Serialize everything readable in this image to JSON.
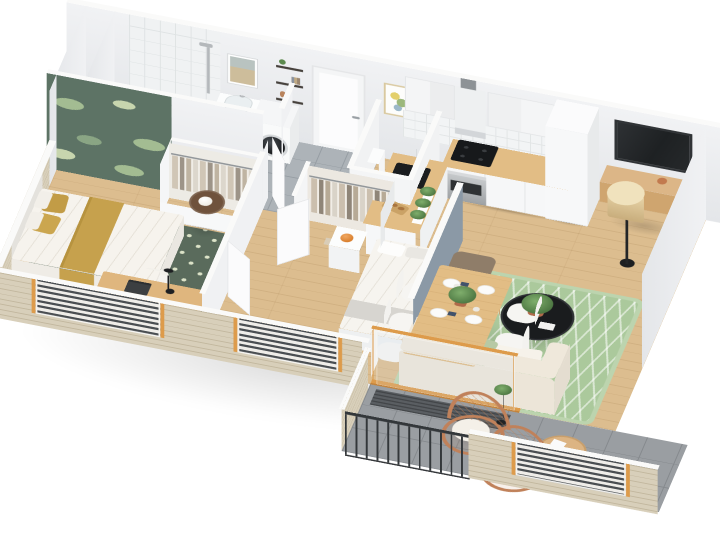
{
  "scene": {
    "title": "3D isometric cutaway floor plan of a two-bedroom apartment with balcony",
    "style": "photoreal-style architectural render, white background, beige brick cutaway facade, white wall caps",
    "canvas": {
      "width": 720,
      "height": 540
    },
    "palette": {
      "cap": "#fafaf9",
      "wall": "#e9ebee",
      "woodFloor": "#dcbd8f",
      "tile": "#adb3b8",
      "tileLine": "#969da3",
      "balcony": "#9a9ea2",
      "balconyLine": "#85898d",
      "brick": "#d8cfba",
      "brickLine": "#c2b79e",
      "greenWall": "#5d7365",
      "leaf": "#a3bc92",
      "mustard": "#c6a14d",
      "rugDark": "#5a6b5c",
      "rugDot": "#dce3c8",
      "rugSage": "#abc99c",
      "blueWall": "#8b99a6",
      "cream": "#ece5d8",
      "furnWhite": "#f6f4ef",
      "counterWood": "#e2bd85",
      "rattan": "#c0815a",
      "tv": "#232628",
      "orange": "#dd9b4b",
      "plantGreen": "#5d8a4e",
      "terracotta": "#b06a4a",
      "steel": "#b7babd",
      "shadow": "rgba(0,0,0,0.16)"
    },
    "rooms": [
      {
        "id": "master-bedroom",
        "label": "Master bedroom",
        "furniture": [
          "double bed with white duvet",
          "mustard yellow pillows and throw",
          "green botanical accent wall",
          "dark green trellis rug",
          "round wooden nightstand with white lamp",
          "wooden desk with laptop and black desk lamp",
          "white desk chair",
          "open wardrobe with hanging clothes",
          "louver shutter window"
        ]
      },
      {
        "id": "bathroom",
        "label": "Bathroom",
        "furniture": [
          "walk-in tiled shower with glass screen",
          "white vanity with basin",
          "washing machine",
          "framed picture",
          "wall shelf column with books and plants",
          "gray tile floor"
        ]
      },
      {
        "id": "hallway",
        "label": "Entrance hall",
        "furniture": [
          "white entrance door",
          "open interior door leaves"
        ]
      },
      {
        "id": "wc",
        "label": "WC",
        "furniture": [
          "toilet with cistern"
        ]
      },
      {
        "id": "second-bedroom",
        "label": "Second bedroom",
        "furniture": [
          "single bed with white bedding",
          "blue-gray partition wall",
          "open closet with clothes",
          "nightstand with orange lamp"
        ]
      },
      {
        "id": "kitchen",
        "label": "Kitchen",
        "furniture": [
          "white upper cabinets",
          "range hood",
          "tile backsplash",
          "wooden countertop",
          "black cooktop",
          "stainless oven",
          "black sink with faucet",
          "peninsula counter with herb pots",
          "cutting board with bread",
          "tall cabinet"
        ]
      },
      {
        "id": "living-room",
        "label": "Living room",
        "furniture": [
          "wall-mounted TV",
          "floating wooden media console",
          "floor lamp with beige shade",
          "radiator",
          "cream sofa with chaise",
          "green and white zigzag rug",
          "brown ottoman",
          "black round coffee table with potted plant",
          "sliding glass door with orange wood frame"
        ]
      },
      {
        "id": "dining-area",
        "label": "Dining area",
        "furniture": [
          "wooden dining table",
          "six white chairs",
          "white plates with navy napkins",
          "green centerpiece plant"
        ]
      },
      {
        "id": "balcony",
        "label": "Balcony",
        "furniture": [
          "concrete tile floor",
          "dark doormat",
          "metal bar railing",
          "two rattan armchairs with white cushions",
          "round wooden side table",
          "black plant stand",
          "brick parapet with louver shutter"
        ]
      }
    ],
    "exterior": {
      "features": [
        "cutaway beige brick facade",
        "white wall caps",
        "louver shutter window blocks",
        "orange wood window frames"
      ]
    }
  }
}
